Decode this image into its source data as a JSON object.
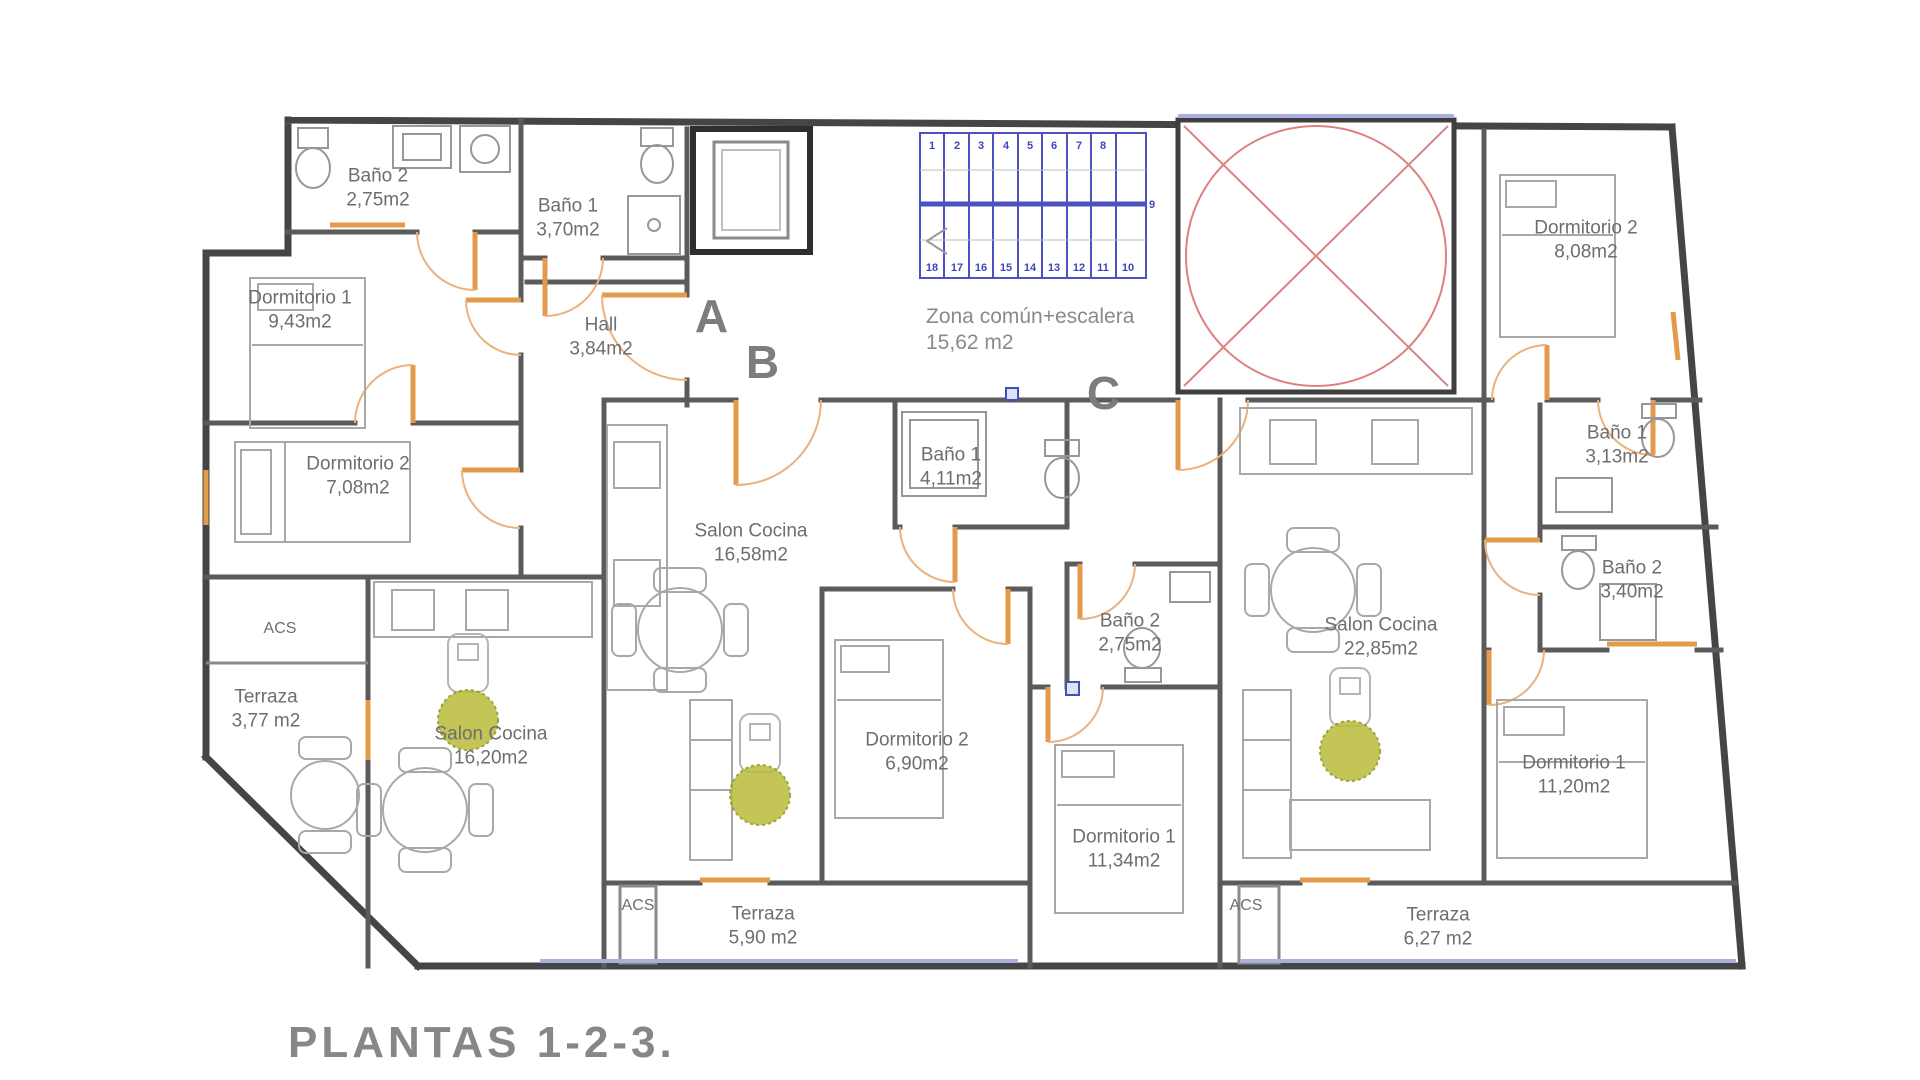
{
  "title": {
    "text": "PLANTAS 1-2-3."
  },
  "letters": {
    "a": "A",
    "b": "B",
    "c": "C"
  },
  "common": {
    "name": "Zona común+escalera",
    "area": "15,62 m2"
  },
  "stairs": {
    "top": [
      "1",
      "2",
      "3",
      "4",
      "5",
      "6",
      "7",
      "8"
    ],
    "mid": "9",
    "bottom": [
      "18",
      "17",
      "16",
      "15",
      "14",
      "13",
      "12",
      "11",
      "10"
    ]
  },
  "rooms": {
    "a_bano2": {
      "name": "Baño 2",
      "area": "2,75m2"
    },
    "a_bano1": {
      "name": "Baño 1",
      "area": "3,70m2"
    },
    "a_dorm1": {
      "name": "Dormitorio 1",
      "area": "9,43m2"
    },
    "a_dorm2": {
      "name": "Dormitorio 2",
      "area": "7,08m2"
    },
    "a_hall": {
      "name": "Hall",
      "area": "3,84m2"
    },
    "a_acs": {
      "name": "ACS"
    },
    "a_terraza": {
      "name": "Terraza",
      "area": "3,77 m2"
    },
    "a_salon": {
      "name": "Salon Cocina",
      "area": "16,20m2"
    },
    "b_salon": {
      "name": "Salon Cocina",
      "area": "16,58m2"
    },
    "b_bano1": {
      "name": "Baño 1",
      "area": "4,11m2"
    },
    "b_bano2": {
      "name": "Baño 2",
      "area": "2,75m2"
    },
    "b_dorm2": {
      "name": "Dormitorio 2",
      "area": "6,90m2"
    },
    "b_dorm1": {
      "name": "Dormitorio 1",
      "area": "11,34m2"
    },
    "b_acs": {
      "name": "ACS"
    },
    "b_terraza": {
      "name": "Terraza",
      "area": "5,90 m2"
    },
    "c_dorm2": {
      "name": "Dormitorio 2",
      "area": "8,08m2"
    },
    "c_bano1": {
      "name": "Baño 1",
      "area": "3,13m2"
    },
    "c_bano2": {
      "name": "Baño 2",
      "area": "3,40m2"
    },
    "c_salon": {
      "name": "Salon Cocina",
      "area": "22,85m2"
    },
    "c_dorm1": {
      "name": "Dormitorio 1",
      "area": "11,20m2"
    },
    "c_acs": {
      "name": "ACS"
    },
    "c_terraza": {
      "name": "Terraza",
      "area": "6,27 m2"
    }
  },
  "colors": {
    "wall": "#454545",
    "door_orange": "#e39a4a",
    "stair_blue": "#4a52c0",
    "patio_red": "#dd8080",
    "window_violet": "#a9b0dd",
    "plant_green": "#b9bd3a",
    "label_gray": "#6e6e6e",
    "title_gray": "#878787"
  }
}
